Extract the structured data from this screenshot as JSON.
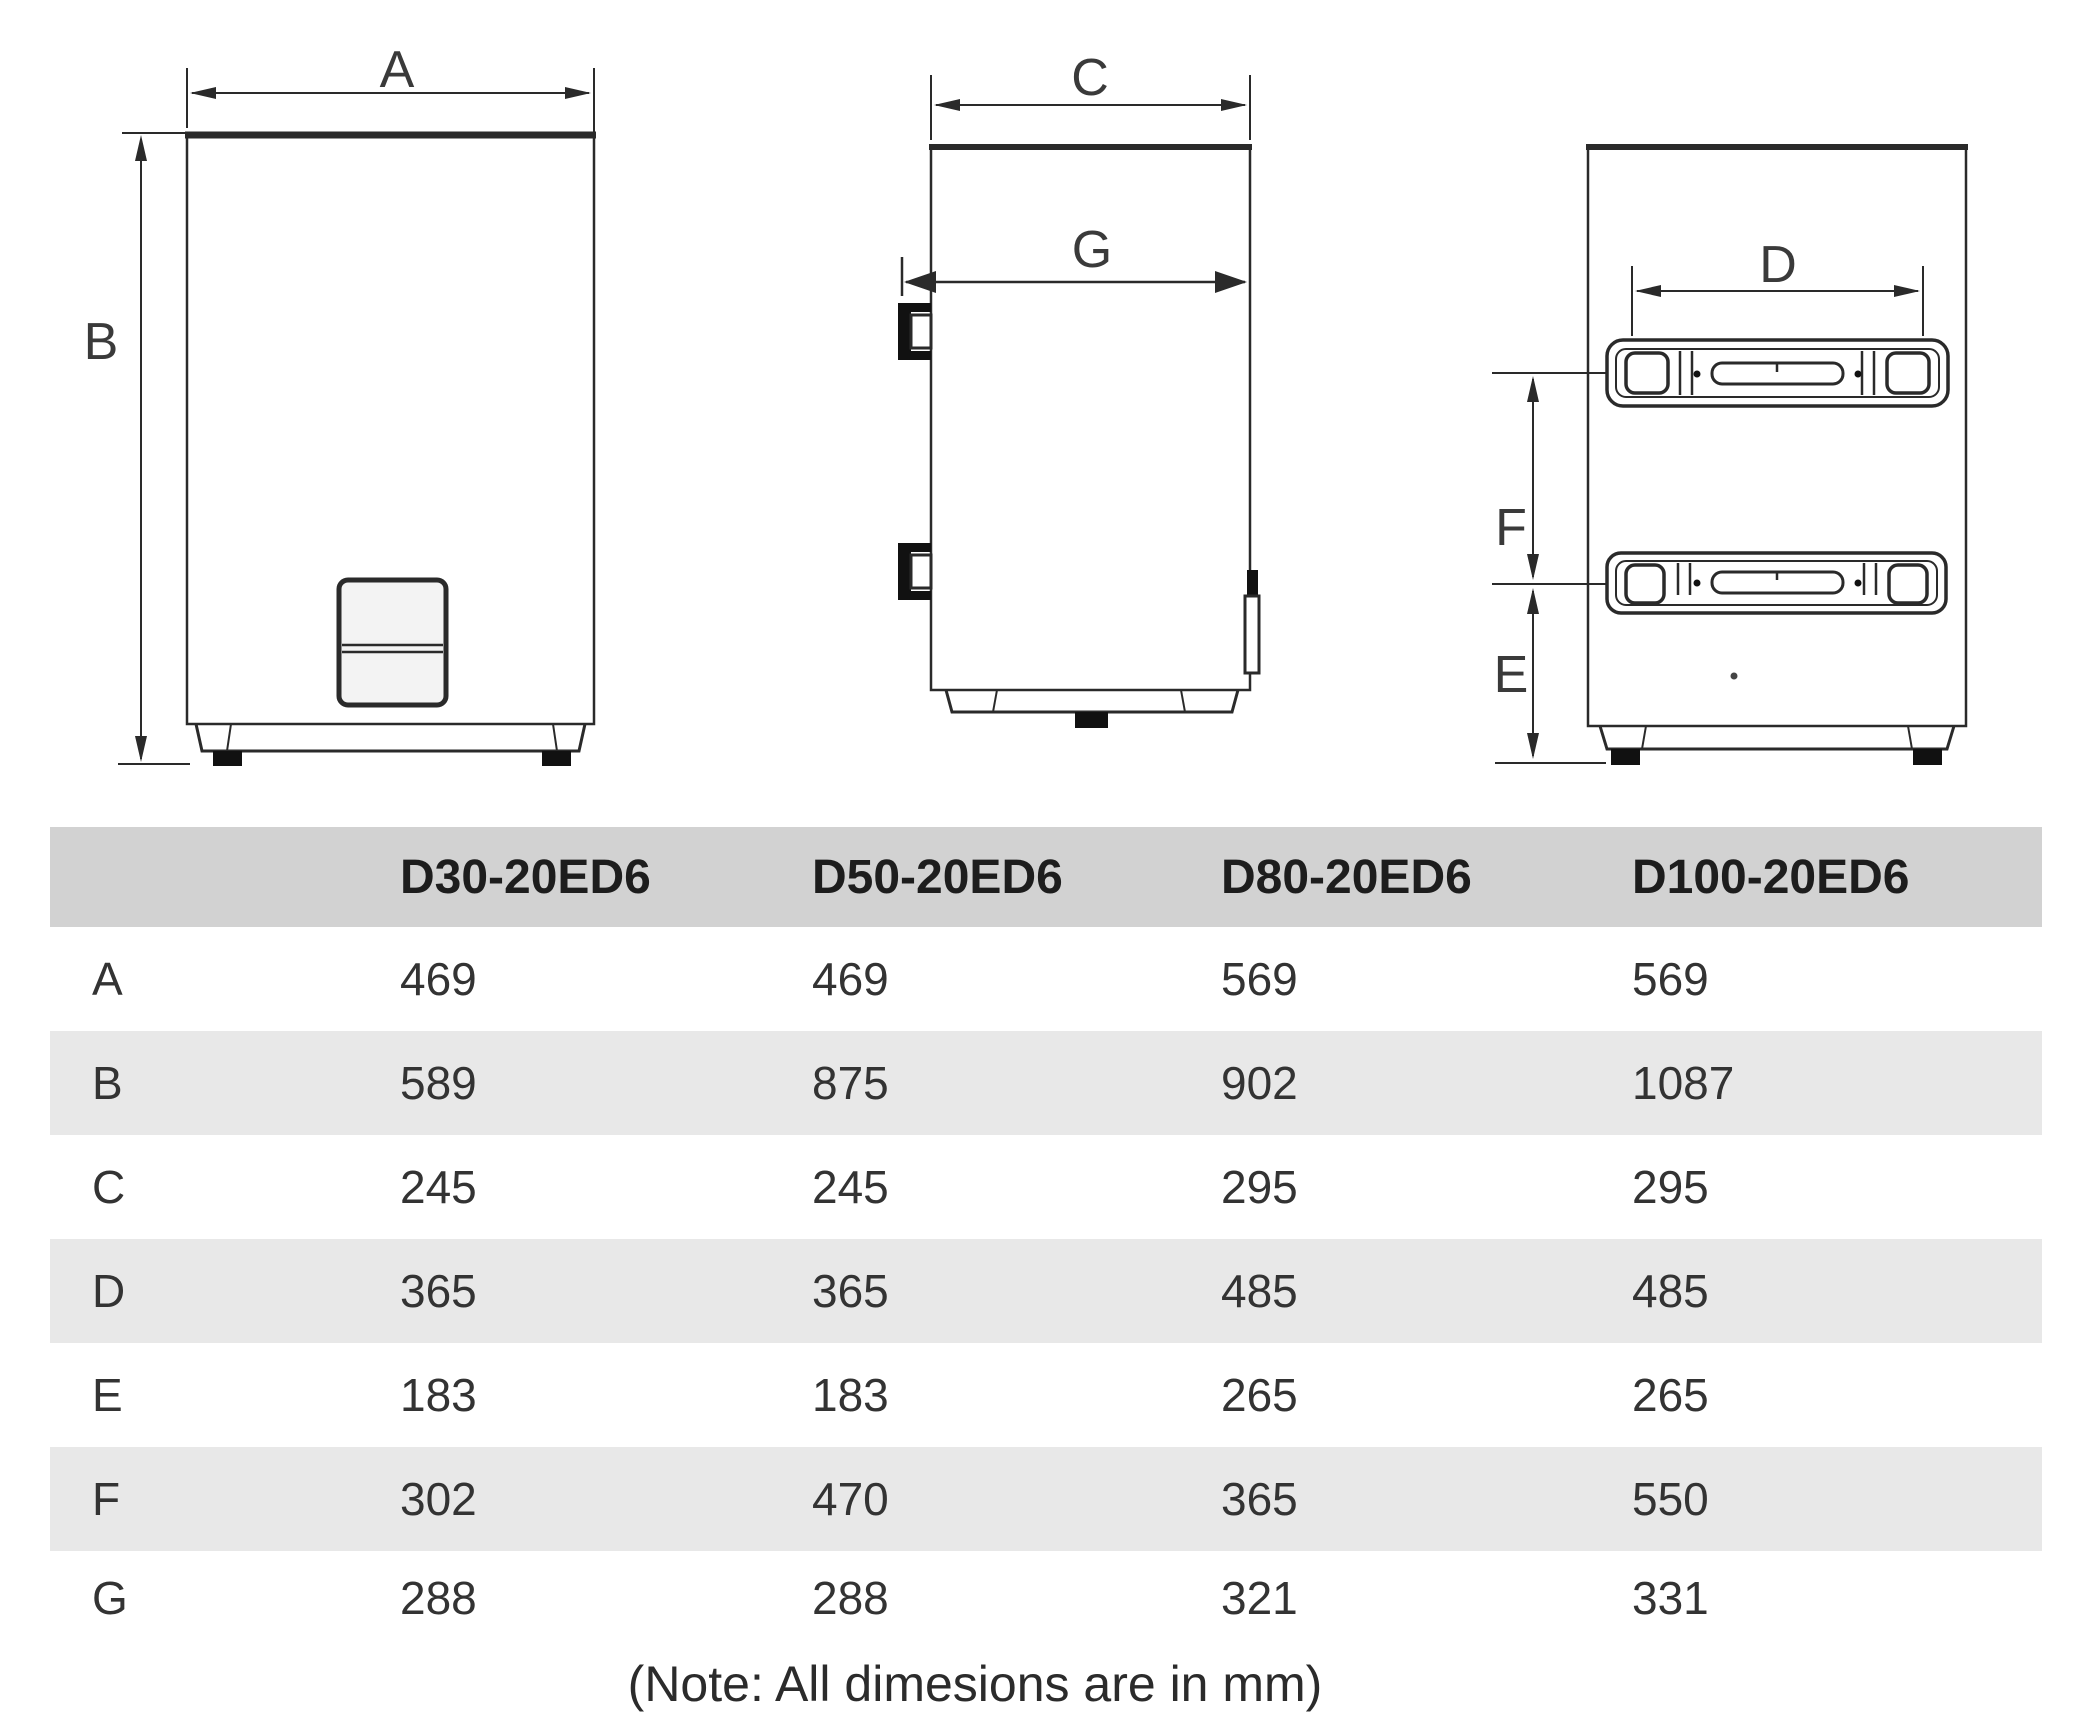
{
  "drawings": {
    "front_view": {
      "width_label": "A",
      "height_label": "B"
    },
    "side_view": {
      "depth_label": "C",
      "bracket_depth_label": "G"
    },
    "rear_view": {
      "bracket_width_label": "D",
      "bottom_offset_label": "E",
      "bracket_spacing_label": "F"
    }
  },
  "table": {
    "columns": [
      "D30-20ED6",
      "D50-20ED6",
      "D80-20ED6",
      "D100-20ED6"
    ],
    "rows": [
      {
        "label": "A",
        "values": [
          "469",
          "469",
          "569",
          "569"
        ]
      },
      {
        "label": "B",
        "values": [
          "589",
          "875",
          "902",
          "1087"
        ]
      },
      {
        "label": "C",
        "values": [
          "245",
          "245",
          "295",
          "295"
        ]
      },
      {
        "label": "D",
        "values": [
          "365",
          "365",
          "485",
          "485"
        ]
      },
      {
        "label": "E",
        "values": [
          "183",
          "183",
          "265",
          "265"
        ]
      },
      {
        "label": "F",
        "values": [
          "302",
          "470",
          "365",
          "550"
        ]
      },
      {
        "label": "G",
        "values": [
          "288",
          "288",
          "321",
          "331"
        ]
      }
    ]
  },
  "note": "(Note: All dimesions are in mm)",
  "colors": {
    "header_bg": "#d2d2d2",
    "alt_row_bg": "#e8e8e8",
    "line": "#2a2a2a",
    "panel_fill": "#f3f3f3"
  }
}
